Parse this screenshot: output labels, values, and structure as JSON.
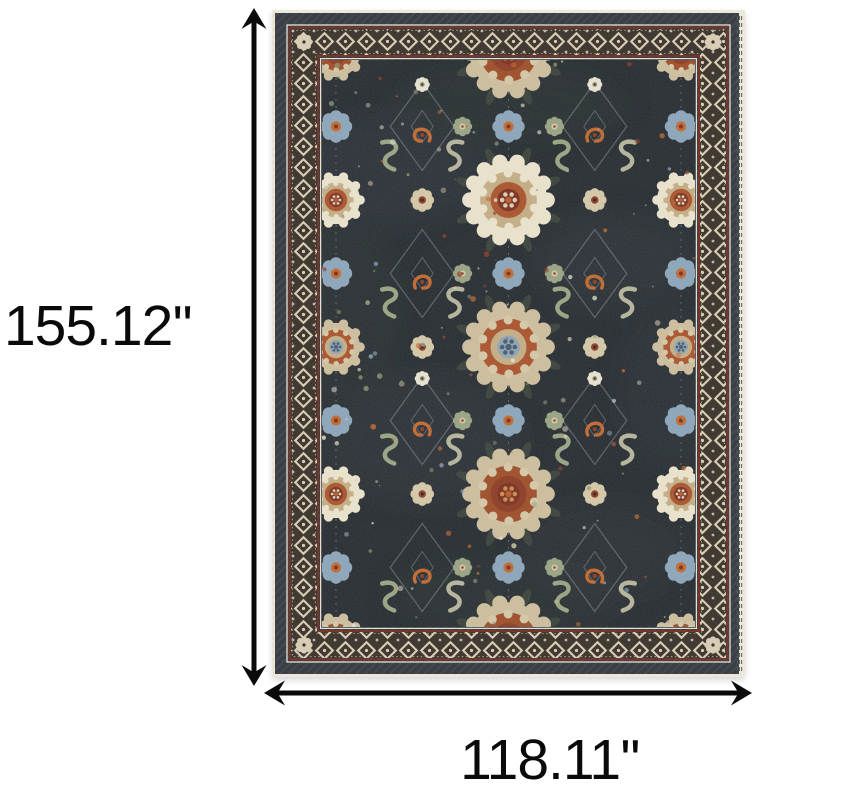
{
  "page": {
    "background": "#ffffff",
    "kind": "product dimension image"
  },
  "product": {
    "description": "Dark navy oriental area rug with multicolor floral medallion pattern and ornate lattice border"
  },
  "dimensions": {
    "height_label": "155.12''",
    "width_label": "118.11''",
    "arrow_color": "#0a0a0a",
    "label_color": "#0a0a0a"
  },
  "rug": {
    "colors": {
      "field": "#252a30",
      "field_sheen": "#4a545e",
      "field_green": "#3a4238",
      "outer_band": "#2f343c",
      "border_ground": "#362f28",
      "lattice_cream": "#d8ccb2",
      "guard_red": "#6f2a1d",
      "edge_cream": "#ece7d8",
      "fringe_shadow": "#51565c",
      "scallop_white": "#e9e1cb",
      "scallop_beige": "#cbbc9b",
      "ring_tan": "#c2ab83",
      "ring_rust": "#a8512a",
      "center_red": "#7a2e1d",
      "center_blue": "#8ba2b5",
      "center_blue_dark": "#46586b",
      "flower_blue": "#8aa3b9",
      "flower_beige": "#d3c6a6",
      "flower_sage": "#97a181",
      "accent_orange": "#c0662c",
      "accent_red": "#8c3a22",
      "accent_olive": "#878c6a",
      "detail_cream": "#e6e1d2",
      "line_faint": "rgba(205,215,220,0.30)"
    }
  }
}
